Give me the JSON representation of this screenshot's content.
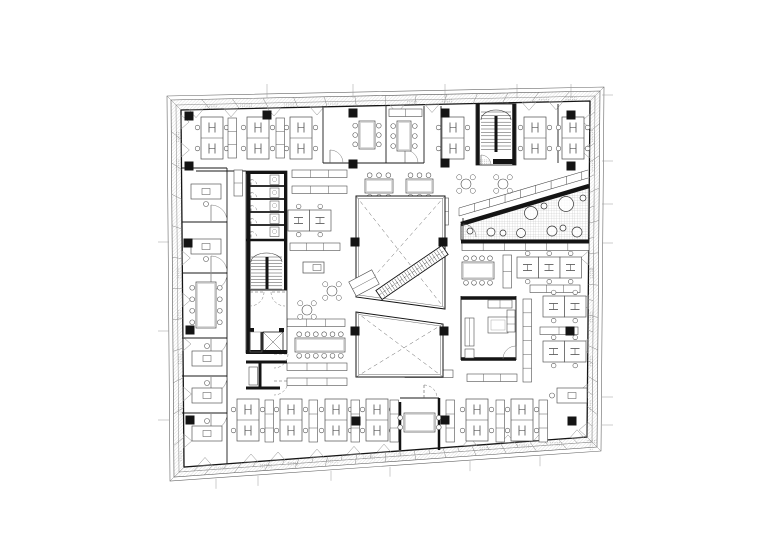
{
  "canvas": {
    "width": 780,
    "height": 552,
    "background": "#ffffff"
  },
  "palette": {
    "ink": "#141414",
    "wall": "#1a1a1a",
    "furniture": "#4d4d4d",
    "light": "#8a8a8a",
    "band": "#d8d8d8",
    "hatch": "#a9a9a9",
    "dash": "#666666"
  },
  "plan": {
    "drawing_type": "office-floor-plan",
    "outline": {
      "outer": [
        [
          167,
          96
        ],
        [
          604,
          87
        ],
        [
          601,
          451
        ],
        [
          170,
          481
        ]
      ],
      "mid1": [
        [
          171,
          100
        ],
        [
          600,
          91
        ],
        [
          597,
          447
        ],
        [
          174,
          477
        ]
      ],
      "mid2": [
        [
          176,
          105
        ],
        [
          595,
          96
        ],
        [
          592,
          442
        ],
        [
          179,
          472
        ]
      ],
      "inner": [
        [
          181,
          110
        ],
        [
          590,
          101
        ],
        [
          587,
          437
        ],
        [
          184,
          467
        ]
      ],
      "tick_spacing": 31
    },
    "grid_ticks": {
      "top": [
        267,
        353,
        445,
        517,
        571
      ],
      "bottom": [
        216,
        258,
        331,
        390,
        470,
        540
      ],
      "left": [
        242,
        331,
        420
      ],
      "right": [
        95,
        161,
        204,
        243,
        397,
        425
      ]
    },
    "vents": {
      "top": [
        196,
        231,
        274,
        317,
        397,
        432,
        529,
        556
      ],
      "bottom": [
        205,
        251,
        278,
        317,
        354,
        384,
        470,
        508,
        541,
        577
      ],
      "left": [
        122,
        150,
        258,
        300,
        344,
        394,
        441
      ],
      "right": [
        121,
        151,
        258,
        302,
        346,
        391,
        430
      ]
    },
    "columns": [
      [
        189,
        116
      ],
      [
        267,
        115
      ],
      [
        353,
        113
      ],
      [
        445,
        113
      ],
      [
        571,
        115
      ],
      [
        189,
        166
      ],
      [
        353,
        164
      ],
      [
        445,
        163
      ],
      [
        571,
        166
      ],
      [
        188,
        243
      ],
      [
        355,
        242
      ],
      [
        443,
        242
      ],
      [
        190,
        330
      ],
      [
        355,
        331
      ],
      [
        444,
        331
      ],
      [
        570,
        331
      ],
      [
        190,
        420
      ],
      [
        356,
        421
      ],
      [
        445,
        420
      ],
      [
        572,
        421
      ]
    ],
    "walls_thin": [
      [
        323,
        106,
        323,
        163
      ],
      [
        386,
        106,
        386,
        163
      ],
      [
        424,
        106,
        424,
        163
      ],
      [
        441,
        106,
        441,
        163
      ],
      [
        323,
        163,
        424,
        163
      ],
      [
        558,
        104,
        558,
        163
      ],
      [
        227,
        168,
        227,
        464
      ],
      [
        182,
        168,
        227,
        168
      ],
      [
        182,
        222,
        227,
        222
      ],
      [
        182,
        273,
        227,
        273
      ],
      [
        182,
        338,
        227,
        338
      ],
      [
        182,
        376,
        227,
        376
      ],
      [
        182,
        413,
        227,
        413
      ],
      [
        196,
        171,
        246,
        171
      ],
      [
        461,
        296,
        461,
        360
      ],
      [
        516,
        296,
        516,
        360
      ],
      [
        400,
        398,
        439,
        398
      ],
      [
        463,
        218,
        463,
        242
      ]
    ],
    "walls_black": [
      [
        461,
        298,
        516,
        298,
        3.5
      ],
      [
        461,
        359,
        516,
        359,
        3.5
      ],
      [
        400,
        402,
        400,
        450,
        2.5
      ],
      [
        439,
        398,
        439,
        450,
        2.5
      ],
      [
        246,
        362,
        287,
        362,
        3
      ],
      [
        260,
        362,
        260,
        389,
        3
      ],
      [
        246,
        388,
        280,
        388,
        3
      ]
    ],
    "clusters": [
      [
        201,
        117
      ],
      [
        247,
        117
      ],
      [
        290,
        117
      ],
      [
        442,
        117
      ],
      [
        524,
        117
      ],
      [
        562,
        117
      ],
      [
        237,
        399
      ],
      [
        280,
        399
      ],
      [
        325,
        399
      ],
      [
        366,
        399
      ],
      [
        466,
        399
      ],
      [
        511,
        399
      ]
    ],
    "cabinets_v": [
      [
        228,
        118,
        40
      ],
      [
        276,
        118,
        40
      ],
      [
        234,
        170,
        26
      ],
      [
        249,
        367,
        18
      ],
      [
        265,
        400,
        42
      ],
      [
        309,
        400,
        42
      ],
      [
        351,
        400,
        42
      ],
      [
        390,
        400,
        42
      ],
      [
        446,
        400,
        42
      ],
      [
        496,
        400,
        42
      ],
      [
        539,
        400,
        42
      ],
      [
        503,
        255,
        33
      ],
      [
        523,
        299,
        83
      ],
      [
        440,
        198,
        27
      ]
    ],
    "cabinets_h": [
      [
        292,
        170,
        55
      ],
      [
        292,
        186,
        55
      ],
      [
        290,
        243,
        50
      ],
      [
        287,
        319,
        58
      ],
      [
        287,
        363,
        60
      ],
      [
        287,
        378,
        60
      ],
      [
        530,
        285,
        50
      ],
      [
        540,
        327,
        38
      ],
      [
        467,
        374,
        50
      ],
      [
        405,
        370,
        48
      ],
      [
        462,
        243,
        127
      ],
      [
        389,
        109,
        33
      ]
    ],
    "desk_rows": [
      [
        517,
        257,
        3
      ],
      [
        543,
        296,
        2
      ],
      [
        543,
        341,
        2
      ],
      [
        288,
        210,
        2
      ]
    ],
    "single_desks": [
      [
        191,
        184,
        "b"
      ],
      [
        191,
        239,
        "b"
      ],
      [
        192,
        351,
        "t"
      ],
      [
        192,
        388,
        "t"
      ],
      [
        192,
        426,
        "t"
      ],
      [
        557,
        388,
        "l"
      ]
    ],
    "tables": [
      {
        "x": 196,
        "y": 282,
        "w": 20,
        "h": 46,
        "chairs": "lr",
        "n": 4
      },
      {
        "x": 359,
        "y": 121,
        "w": 16,
        "h": 28,
        "chairs": "lr",
        "n": 3
      },
      {
        "x": 397,
        "y": 121,
        "w": 14,
        "h": 30,
        "chairs": "lr",
        "n": 3
      },
      {
        "x": 365,
        "y": 179,
        "w": 28,
        "h": 14,
        "chairs": "tb",
        "n": 3
      },
      {
        "x": 406,
        "y": 179,
        "w": 27,
        "h": 14,
        "chairs": "tb",
        "n": 3
      },
      {
        "x": 462,
        "y": 262,
        "w": 32,
        "h": 17,
        "chairs": "tb",
        "n": 4
      },
      {
        "x": 295,
        "y": 338,
        "w": 50,
        "h": 14,
        "chairs": "tb",
        "n": 6
      },
      {
        "x": 404,
        "y": 413,
        "w": 31,
        "h": 19,
        "chairs": "lr",
        "n": 2
      }
    ],
    "round_tables": [
      [
        466,
        184
      ],
      [
        503,
        184
      ],
      [
        332,
        291
      ],
      [
        307,
        310
      ]
    ],
    "island": [
      303,
      262,
      21,
      11
    ],
    "voids": [
      {
        "outer": [
          [
            356,
            196
          ],
          [
            445,
            196
          ],
          [
            445,
            309
          ],
          [
            356,
            297
          ]
        ],
        "inner": [
          [
            358.5,
            198.5
          ],
          [
            442.5,
            198.5
          ],
          [
            442.5,
            306.5
          ],
          [
            358.5,
            295
          ]
        ]
      },
      {
        "outer": [
          [
            356,
            312
          ],
          [
            443,
            324
          ],
          [
            443,
            377
          ],
          [
            356,
            377
          ]
        ],
        "inner": [
          [
            358.5,
            314.5
          ],
          [
            440.5,
            326
          ],
          [
            440.5,
            374.5
          ],
          [
            358.5,
            374.5
          ]
        ]
      }
    ],
    "escalator": {
      "x1": 379,
      "y1": 295,
      "x2": 445,
      "y2": 250,
      "hw": 5.5
    },
    "ramp": {
      "cx": 364,
      "cy": 283,
      "w": 26,
      "h": 16,
      "angle": -28
    },
    "terrace": {
      "poly": [
        [
          461,
          224
        ],
        [
          589,
          186
        ],
        [
          589,
          240
        ],
        [
          461,
          240
        ]
      ],
      "top_edge": [
        461,
        224,
        589,
        186
      ],
      "bottom_edge": [
        461,
        241.5,
        589,
        241.5
      ],
      "band": [
        [
          459,
          216,
          588,
          178
        ],
        [
          459,
          208,
          588,
          170
        ]
      ],
      "trees": [
        [
          531,
          213,
          6.5
        ],
        [
          566,
          204,
          7.5
        ],
        [
          544,
          206,
          3
        ],
        [
          583,
          198,
          3
        ],
        [
          470,
          231,
          3
        ],
        [
          491,
          232,
          4
        ],
        [
          503,
          233,
          3
        ],
        [
          521,
          233,
          4.5
        ],
        [
          552,
          231,
          5
        ],
        [
          563,
          228,
          3
        ],
        [
          577,
          232,
          5
        ]
      ],
      "door": [
        463,
        237,
        13
      ]
    },
    "stair_top": {
      "x": 476,
      "y": 104,
      "w": 40,
      "h": 61
    },
    "core_left": {
      "x": 246,
      "y": 171,
      "w": 41,
      "h": 182
    },
    "exec_room": {
      "x": 461,
      "y": 296
    },
    "door_arcs": [
      [
        211,
        221,
        16,
        "ne",
        0
      ],
      [
        211,
        272,
        16,
        "ne",
        0
      ],
      [
        211,
        274,
        16,
        "se",
        0
      ],
      [
        211,
        339,
        16,
        "se",
        0
      ],
      [
        211,
        377,
        16,
        "se",
        0
      ],
      [
        211,
        414,
        16,
        "se",
        0
      ],
      [
        330,
        163,
        13,
        "ne",
        0
      ],
      [
        405,
        163,
        13,
        "ne",
        0
      ],
      [
        424,
        398,
        13,
        "ne",
        1
      ],
      [
        274,
        354,
        14,
        "es",
        1
      ],
      [
        274,
        381,
        14,
        "es",
        1
      ],
      [
        516,
        359,
        13,
        "nw",
        0
      ],
      [
        463,
        237,
        13,
        "ne",
        0
      ]
    ]
  }
}
